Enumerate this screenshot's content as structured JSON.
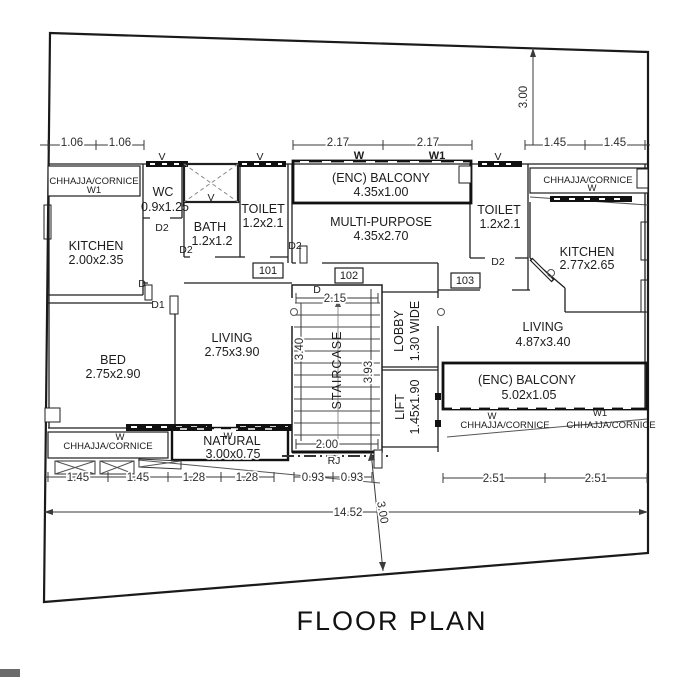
{
  "title": "FLOOR PLAN",
  "rooms": {
    "kitchenL": {
      "name": "KITCHEN",
      "size": "2.00x2.35"
    },
    "wc": {
      "name": "WC",
      "size": "0.9x1.25"
    },
    "bath": {
      "name": "BATH",
      "size": "1.2x1.2"
    },
    "toiletL": {
      "name": "TOILET",
      "size": "1.2x2.1"
    },
    "balconyTop": {
      "name": "(ENC) BALCONY",
      "size": "4.35x1.00"
    },
    "multi": {
      "name": "MULTI-PURPOSE",
      "size": "4.35x2.70"
    },
    "toiletR": {
      "name": "TOILET",
      "size": "1.2x2.1"
    },
    "kitchenR": {
      "name": "KITCHEN",
      "size": "2.77x2.65"
    },
    "bed": {
      "name": "BED",
      "size": "2.75x2.90"
    },
    "livingL": {
      "name": "LIVING",
      "size": "2.75x3.90"
    },
    "livingR": {
      "name": "LIVING",
      "size": "4.87x3.40"
    },
    "staircase": {
      "name": "STAIRCASE"
    },
    "lobby": {
      "name": "LOBBY",
      "size": "1.30 WIDE"
    },
    "lift": {
      "name": "LIFT",
      "size": "1.45x1.90"
    },
    "balconyR": {
      "name": "(ENC) BALCONY",
      "size": "5.02x1.05"
    },
    "natural": {
      "name": "NATURAL",
      "size": "3.00x0.75"
    }
  },
  "cornice": {
    "label": "CHHAJJA/CORNICE"
  },
  "units": {
    "u101": "101",
    "u102": "102",
    "u103": "103"
  },
  "doors": {
    "d": "D",
    "d1": "D1",
    "d2": "D2"
  },
  "windows": {
    "v": "V",
    "w": "W",
    "w1": "W1"
  },
  "marks": {
    "rj": "RJ"
  },
  "dims": {
    "topL1": "1.06",
    "topL2": "1.06",
    "topM1": "2.17",
    "topM2": "2.17",
    "topR1": "1.45",
    "topR2": "1.45",
    "vTopRight": "3.00",
    "stairW": "2.15",
    "stairH1": "3.40",
    "stairH2": "3.93",
    "stairB": "2.00",
    "botL1": "1.45",
    "botL2": "1.45",
    "botL3": "1.28",
    "botL4": "1.28",
    "botL5": "0.93",
    "botL6": "0.93",
    "botR1": "2.51",
    "botR2": "2.51",
    "total": "14.52",
    "vBottom": "3.00"
  },
  "colors": {
    "line": "#1f1f1f",
    "dim": "#3a3a3a",
    "background": "#ffffff"
  }
}
